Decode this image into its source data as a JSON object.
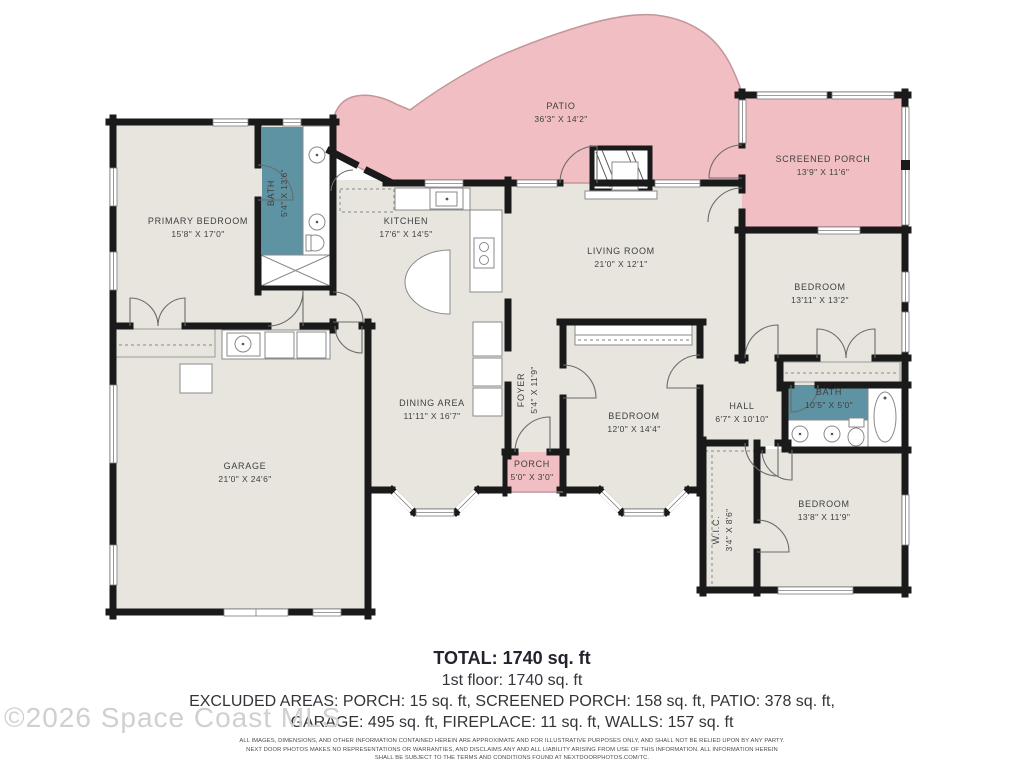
{
  "watermark": "©2026 Space Coast MLS",
  "colors": {
    "floor": "#e7e5de",
    "outdoor": "#f1bfc3",
    "bath": "#5e93a3",
    "wall": "#1a1a1a"
  },
  "rooms": {
    "primary_bedroom": {
      "name": "PRIMARY BEDROOM",
      "dims": "15'8\" X 17'0\""
    },
    "bath_primary": {
      "name": "BATH",
      "dims": "5'4\" X 13'6\""
    },
    "patio": {
      "name": "PATIO",
      "dims": "36'3\" X 14'2\""
    },
    "screened_porch": {
      "name": "SCREENED PORCH",
      "dims": "13'9\" X 11'6\""
    },
    "kitchen": {
      "name": "KITCHEN",
      "dims": "17'6\" X 14'5\""
    },
    "living_room": {
      "name": "LIVING ROOM",
      "dims": "21'0\" X 12'1\""
    },
    "bedroom_ne": {
      "name": "BEDROOM",
      "dims": "13'11\" X 13'2\""
    },
    "dining_area": {
      "name": "DINING AREA",
      "dims": "11'11\" X 16'7\""
    },
    "foyer": {
      "name": "FOYER",
      "dims": "5'4\" X 11'9\""
    },
    "bedroom_mid": {
      "name": "BEDROOM",
      "dims": "12'0\" X 14'4\""
    },
    "hall": {
      "name": "HALL",
      "dims": "6'7\" X 10'10\""
    },
    "bath_hall": {
      "name": "BATH",
      "dims": "10'5\" X 5'0\""
    },
    "bedroom_se": {
      "name": "BEDROOM",
      "dims": "13'8\" X 11'9\""
    },
    "wic": {
      "name": "W.I.C.",
      "dims": "3'4\" X 8'6\""
    },
    "garage": {
      "name": "GARAGE",
      "dims": "21'0\" X 24'6\""
    },
    "porch": {
      "name": "PORCH",
      "dims": "5'0\" X 3'0\""
    }
  },
  "summary": {
    "total": "TOTAL: 1740 sq. ft",
    "floor1": "1st floor: 1740 sq. ft",
    "excluded_line1": "EXCLUDED AREAS: PORCH: 15 sq. ft, SCREENED PORCH: 158 sq. ft, PATIO: 378 sq. ft,",
    "excluded_line2": "GARAGE: 495 sq. ft, FIREPLACE: 11 sq. ft, WALLS: 157 sq. ft",
    "disclaimer_line1": "ALL IMAGES, DIMENSIONS, AND OTHER INFORMATION CONTAINED HEREIN ARE APPROXIMATE AND FOR ILLUSTRATIVE PURPOSES ONLY, AND SHALL NOT BE RELIED UPON BY ANY PARTY.",
    "disclaimer_line2": "NEXT DOOR PHOTOS MAKES NO REPRESENTATIONS OR WARRANTIES, AND DISCLAIMS ANY AND ALL LIABILITY ARISING FROM USE OF THIS INFORMATION. ALL INFORMATION HEREIN",
    "disclaimer_line3": "SHALL BE SUBJECT TO THE TERMS AND CONDITIONS FOUND AT NEXTDOORPHOTOS.COM/TC."
  }
}
